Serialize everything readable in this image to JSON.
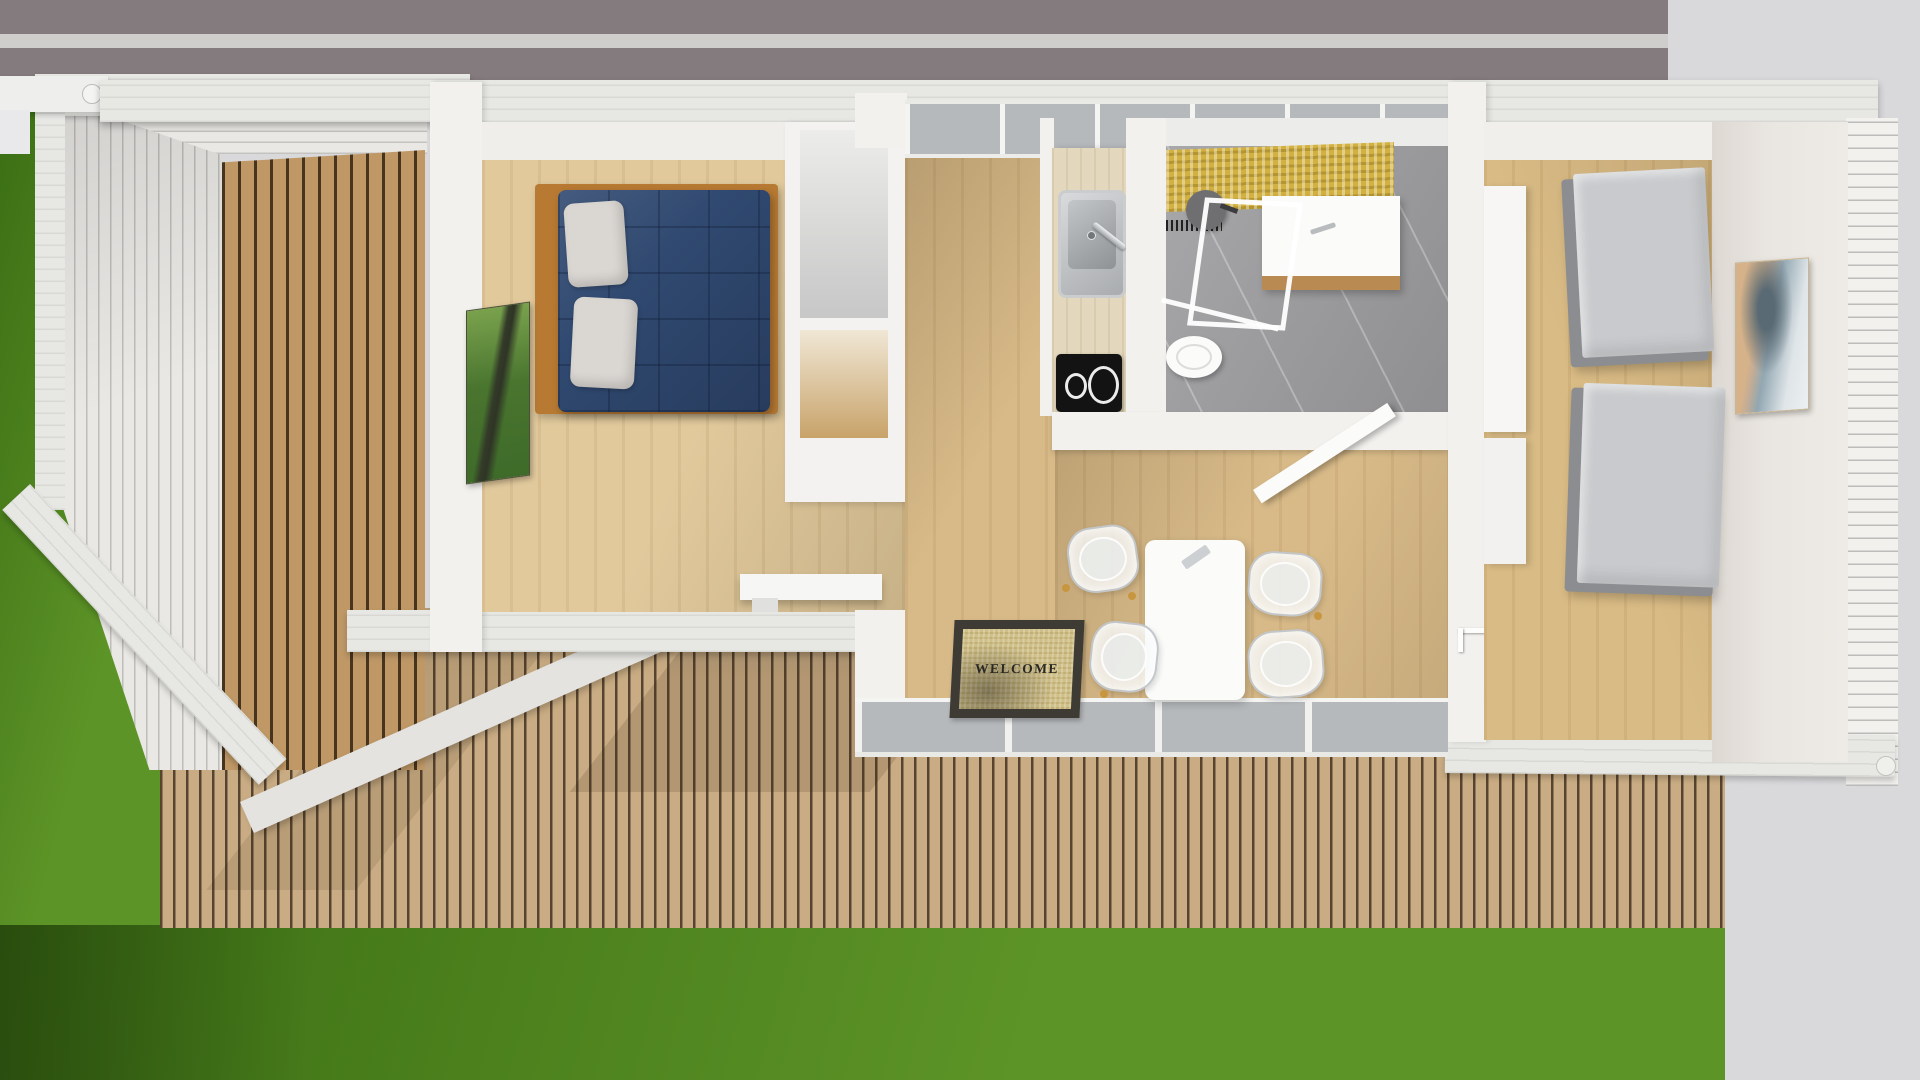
{
  "entry_mat": {
    "text": "WELCOME"
  },
  "counts": {
    "dining_chairs": 4,
    "cooktop_burners": 2,
    "guest_beds": 2,
    "bed_pillows": 2,
    "wall_artworks": 2
  },
  "objects": [
    "road",
    "lawn",
    "wood-deck",
    "carport-slatted",
    "double-bed",
    "forest-artwork",
    "open-shelving",
    "floating-desk",
    "kitchenette-sink",
    "induction-cooktop",
    "bathroom-shower",
    "vanity",
    "toilet",
    "welcome-doormat",
    "dining-table",
    "ghost-chairs",
    "guest-beds",
    "seascape-artwork",
    "wardrobe",
    "clerestory-window",
    "sliding-glass-doors"
  ],
  "colors": {
    "pavement": "#d9d9db",
    "road": "#847b7e",
    "road-line": "#d7d7d5",
    "grass-light": "#5d9427",
    "grass-dark": "#3b6e14",
    "deck-wood": "#c9ac83",
    "deck-gap": "#574430",
    "carport-wood": "#bf9866",
    "carport-gap": "#46341f",
    "white-slat": "#e9e8e5",
    "frame-white": "#e7e7e4",
    "wall-white": "#f2f1ee",
    "siding-line": "#bcbcba",
    "floor-bedroom": "#e1c99c",
    "floor-hall": "#d8ba88",
    "floor-bedroom2": "#d9bb85",
    "grain": "rgba(120,80,30,0.09)",
    "bed-frame": "#b87a33",
    "bed-duvet": "#304970",
    "bed-duvet-line": "rgba(10,20,45,0.28)",
    "pillow": "#dad6d2",
    "art-green-1": "#7aa24d",
    "art-green-2": "#49752f",
    "art-trunk": "#333a28",
    "shelf-white": "#f3f2f0",
    "cubby-gray": "#c7c7c7",
    "cubby-wood": "#c8a36a",
    "desk-white": "#f6f6f4",
    "counter-wood": "#e3d8bd",
    "steel-light": "#d8dadc",
    "steel-dark": "#a9acaf",
    "cooktop": "#131313",
    "burner-ring": "#ececec",
    "glass": "#b6b9bc",
    "marble": "#a1a1a3",
    "mosaic": "#d2b140",
    "vanity-wood": "#b98a52",
    "porcelain": "#fbfbfa",
    "mat-border": "#3d3b34",
    "mat-face": "#cfbf88",
    "mat-text": "#2a2822",
    "table": "#fbfbfa",
    "chair-fill": "rgba(246,248,250,0.78)",
    "chair-edge": "rgba(190,194,198,0.9)",
    "chair-leg": "#c8963f",
    "mattress": "#c8cacd",
    "mattress-frame": "#8b8d90",
    "art-sand": "#d5b28a",
    "art-sea": "#92a7b2",
    "art-sky": "#dfe5e8",
    "shadow": "rgba(45,35,20,0.15)"
  }
}
